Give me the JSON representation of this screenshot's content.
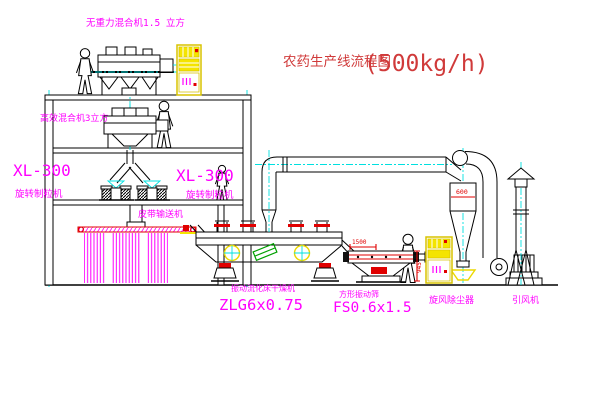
{
  "window": {
    "width": 600,
    "height": 403,
    "background": "#ffffff"
  },
  "title": {
    "text": "农药生产线流程图",
    "capacity": "(500kg/h)"
  },
  "labels": {
    "top_mixer": "无重力混合机1.5 立方",
    "mid_mixer": "高效混合机3立方",
    "xl_left_model": "XL-300",
    "xl_left_name": "旋转制粒机",
    "xl_right_model": "XL-300",
    "xl_right_name": "旋转制粒机",
    "belt": "皮带输送机",
    "dryer_name": "振动流化床干燥机",
    "dryer_model": "ZLG6x0.75",
    "screen_name": "方形振动筛",
    "screen_model": "FS0.6x1.5",
    "cyclone": "旋风除尘器",
    "fan": "引风机"
  },
  "dimensions": {
    "cyclone_dia": "600",
    "screen_length": "1500",
    "screen_height": "945"
  },
  "colors": {
    "label_magenta": "#ff00ff",
    "title_red": "#d03a3a",
    "dimension_red": "#e00000",
    "centerline_cyan": "#00e0e0",
    "cabinet_yellow": "#f4e400",
    "accent_green": "#00a000",
    "line_black": "#000000"
  }
}
